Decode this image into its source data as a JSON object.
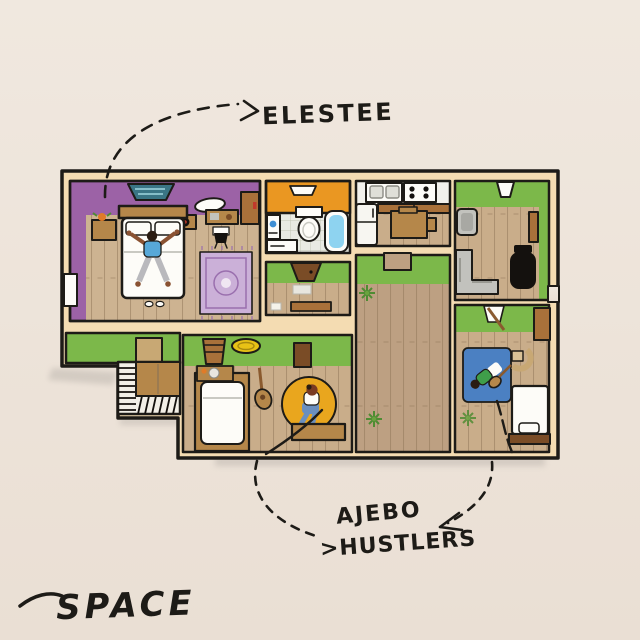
{
  "artwork": {
    "kind": "hand-drawn apartment floor-plan album art",
    "labels": {
      "artist_top": "ELESTEE",
      "artist_bottom_line1": "AJEBO",
      "artist_bottom_line2": ">HUSTLERS",
      "album_title": "SPACE"
    },
    "scene": {
      "rooms": [
        "main-bedroom",
        "bathroom",
        "entry-hall",
        "kitchen",
        "living-room",
        "hallway",
        "bedroom-2",
        "bedroom-3",
        "stairwell"
      ],
      "figures": [
        "person-on-bed",
        "person-on-yellow-rug",
        "person-with-guitar-on-blue-rug"
      ]
    }
  },
  "palette": {
    "bg1": "#f0e8df",
    "bg2": "#eadfd4",
    "ink": "#1d1b17",
    "wall": "#f4dcb2",
    "floor": "#c9ad8a",
    "floorD": "#bda082",
    "floorL": "#cdb391",
    "green": "#7cb84a",
    "purple": "#9c62a6",
    "orange": "#ea9722",
    "tile": "#e9eae3",
    "white": "#fdfcf8",
    "wood": "#b5874a",
    "brown": "#a9713a",
    "brownD": "#7a4c26",
    "gray": "#c2c2bd",
    "black": "#14110e",
    "tub": "#8ed3f0",
    "rugB": "#4b80c2",
    "rugY": "#e9a61e",
    "rugP": "#cbb0d8",
    "dishY": "#e8c216",
    "skin": "#8a5232",
    "shirtB": "#57a8d8",
    "jeans": "#6b8fbe",
    "pantsG": "#b9b9bd",
    "shirtG": "#3f9e4a",
    "hairR": "#7a3b22",
    "chairT": "#c8a874",
    "tv": "#3a7585",
    "shadow": "#9a958f"
  }
}
